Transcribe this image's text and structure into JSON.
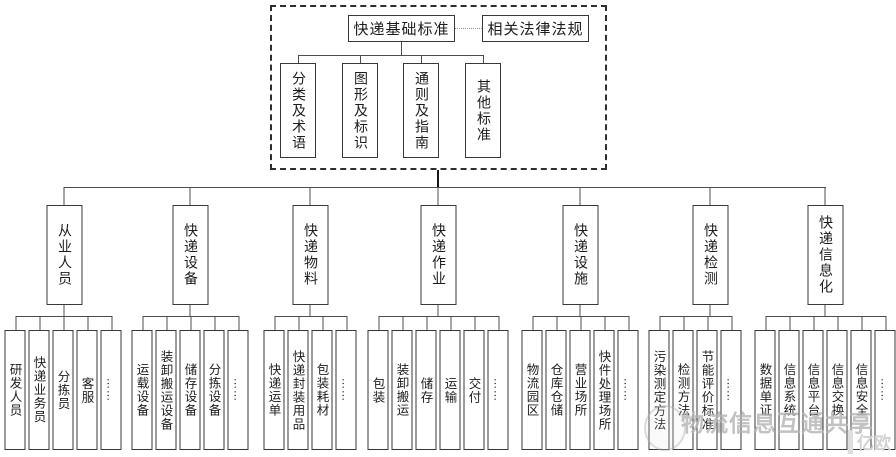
{
  "top": {
    "root": "快递基础标准",
    "related": "相关法律法规",
    "children": [
      "分类及术语",
      "图形及标识",
      "通则及指南",
      "其他标准"
    ]
  },
  "branches": [
    {
      "label": "从业人员",
      "children": [
        "研发人员",
        "快递业务员",
        "分拣员",
        "客服",
        "……"
      ]
    },
    {
      "label": "快递设备",
      "children": [
        "运载设备",
        "装卸搬运设备",
        "储存设备",
        "分拣设备",
        "……"
      ]
    },
    {
      "label": "快递物料",
      "children": [
        "快递运单",
        "快递封装用品",
        "包装耗材",
        "……"
      ]
    },
    {
      "label": "快递作业",
      "children": [
        "包装",
        "装卸搬运",
        "储存",
        "运输",
        "交付",
        "……"
      ]
    },
    {
      "label": "快递设施",
      "children": [
        "物流园区",
        "仓库仓储",
        "营业场所",
        "快件处理场所",
        "……"
      ]
    },
    {
      "label": "快递检测",
      "children": [
        "污染测定方法",
        "检测方法",
        "节能评价标准",
        "……"
      ]
    },
    {
      "label": "快递信息化",
      "children": [
        "数据单证",
        "信息系统",
        "信息平台",
        "信息交换",
        "信息安全",
        "……"
      ]
    }
  ],
  "watermark": {
    "text": "物流信息互通共享",
    "logo": "亿欧"
  },
  "colors": {
    "background": "#ffffff",
    "box_border": "#383838",
    "line": "#4d4d4d",
    "dashed_border": "#2e2e2e",
    "watermark": "#b3b3b3"
  }
}
